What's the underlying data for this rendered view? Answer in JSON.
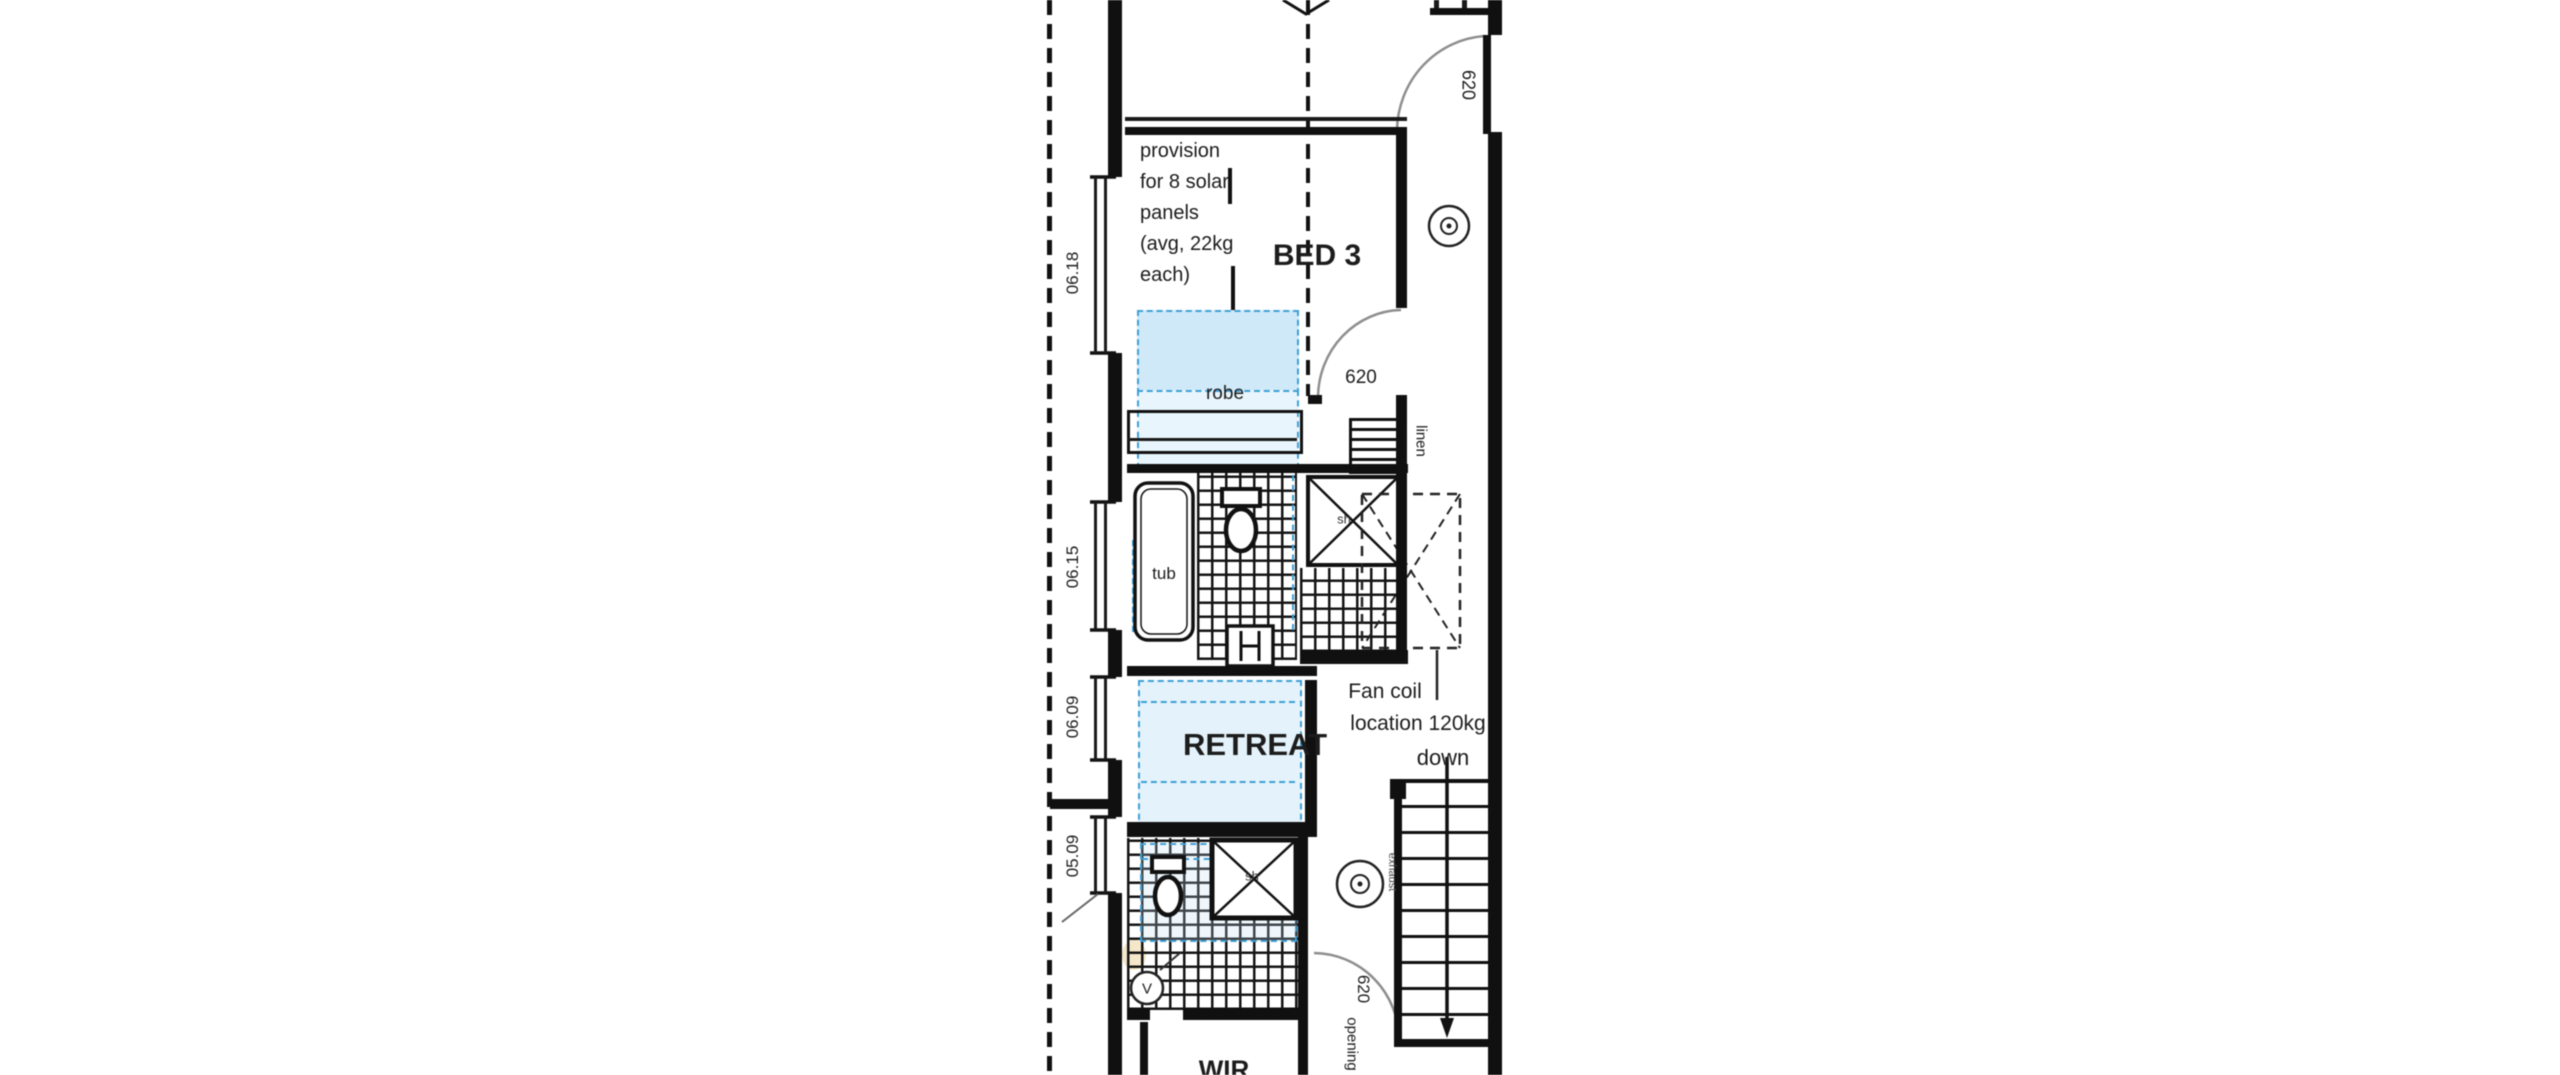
{
  "plan": {
    "rooms": {
      "bed3": "BED 3",
      "retreat": "RETREAT",
      "wir": "WIR"
    },
    "fittings": {
      "robe": "robe",
      "tub": "tub",
      "linen": "linen"
    },
    "solar_note": [
      "provision",
      "for 8 solar",
      "panels",
      "(avg, 22kg",
      "each)"
    ],
    "fan_coil": {
      "line1": "Fan coil",
      "line2": "location 120kg"
    },
    "stairs": {
      "direction": "down"
    },
    "doors": {
      "top_width": "620",
      "robe_width": "620",
      "wir_width": "620",
      "wir_opening": "opening"
    },
    "windows": [
      "06.18",
      "06.15",
      "06.09",
      "05.09"
    ],
    "symbols": {
      "vent": "V",
      "exhaust": "exhaust",
      "shower1": "sh",
      "shower2": "sh"
    },
    "colors": {
      "line": "#111111",
      "skylight_border": "#3d9fd6",
      "skylight_fill": "#d9eefb"
    }
  }
}
